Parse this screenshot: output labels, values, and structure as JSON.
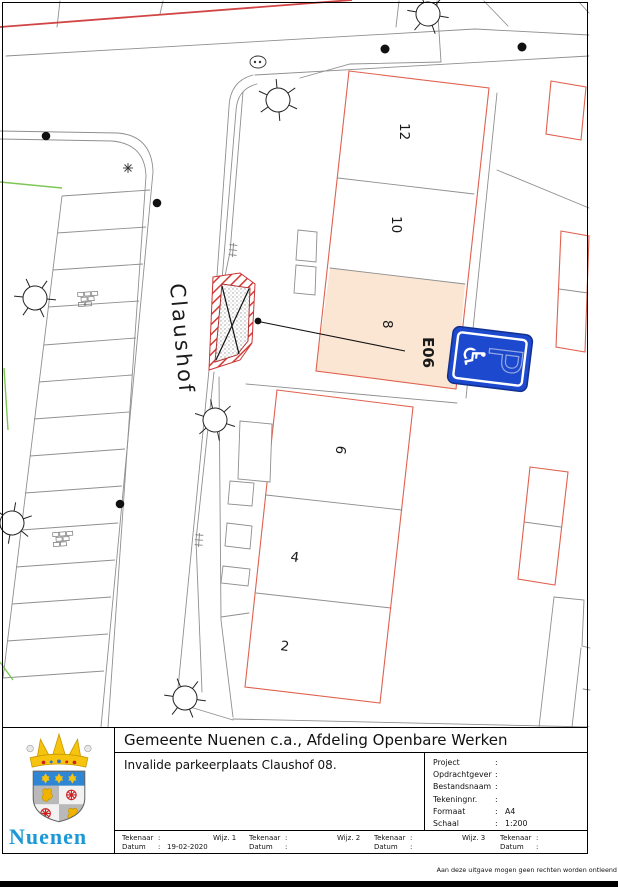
{
  "map": {
    "street_label": "Claushof",
    "house_numbers": [
      "12",
      "10",
      "8",
      "6",
      "4",
      "2"
    ],
    "parking_sign": {
      "code_label": "E06",
      "p_letter": "P",
      "wheelchair_icon": "♿"
    },
    "colors": {
      "outline_red": "#e0614f",
      "hatch_red": "#d23b35",
      "highlight_peach": "#fbe6d3",
      "road_gray": "#8f8f8f",
      "green_line": "#7dc855",
      "sign_blue": "#1d49cf",
      "logo_blue": "#1b98d5"
    }
  },
  "title_block": {
    "title": "Gemeente Nuenen c.a., Afdeling Openbare Werken",
    "subtitle": "Invalide parkeerplaats Claushof 08.",
    "colon": ":",
    "fields": [
      {
        "label": "Project",
        "value": ""
      },
      {
        "label": "Opdrachtgever",
        "value": ""
      },
      {
        "label": "Bestandsnaam",
        "value": ""
      },
      {
        "label": "Tekeningnr.",
        "value": ""
      },
      {
        "label": "Formaat",
        "value": "A4"
      },
      {
        "label": "Schaal",
        "value": "1:200"
      }
    ],
    "tekenaar_label": "Tekenaar",
    "datum_label": "Datum",
    "revisions": [
      {
        "wijz": "Wijz. 1",
        "tekenaar": "",
        "datum": "19-02-2020"
      },
      {
        "wijz": "Wijz. 2",
        "tekenaar": "",
        "datum": ""
      },
      {
        "wijz": "Wijz. 3",
        "tekenaar": "",
        "datum": ""
      },
      {
        "tekenaar": "",
        "datum": ""
      }
    ],
    "logo_text": "Nuenen"
  },
  "footer": {
    "disclaimer": "Aan deze uitgave mogen geen rechten worden ontleend"
  }
}
